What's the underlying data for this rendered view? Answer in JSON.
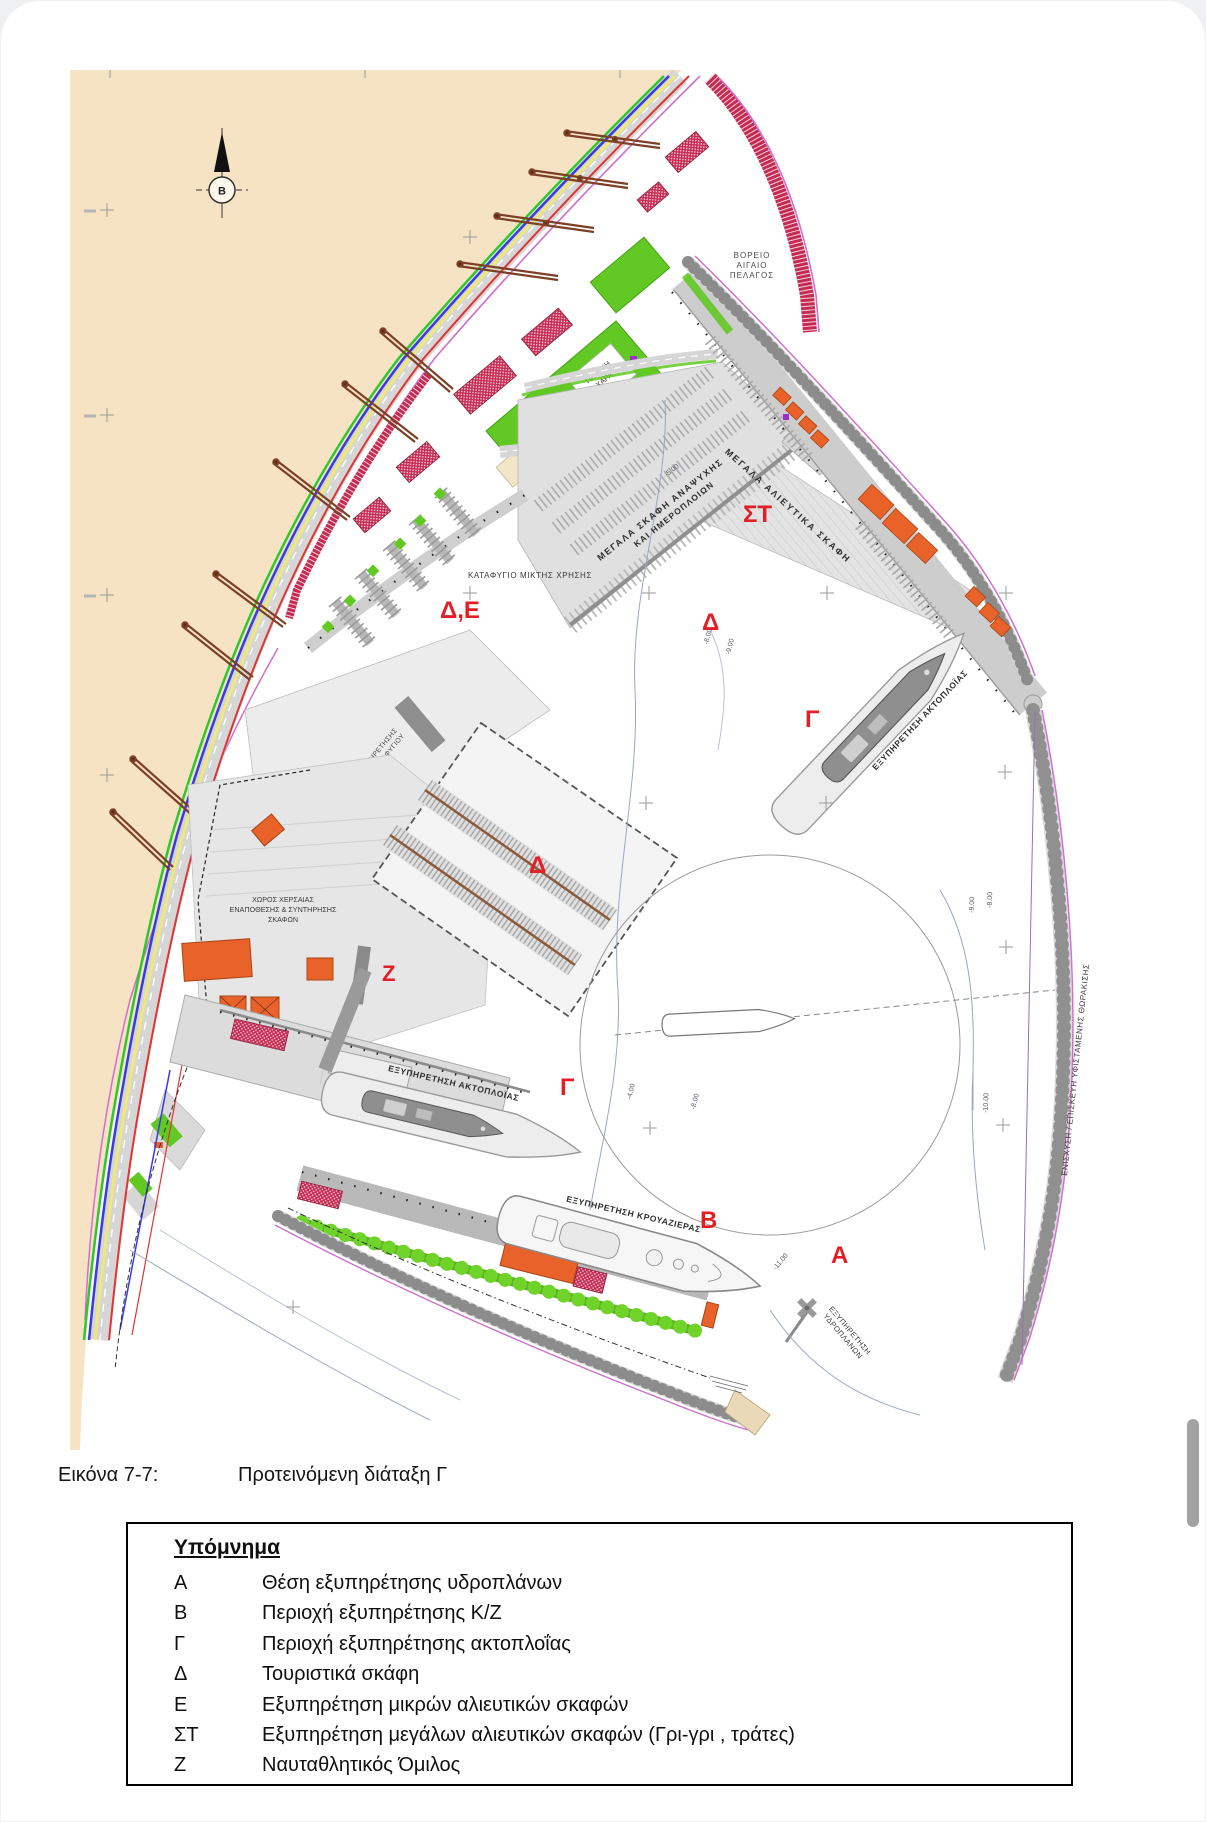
{
  "caption": {
    "figure_label": "Εικόνα 7-7:",
    "figure_title": "Προτεινόμενη διάταξη Γ"
  },
  "legend": {
    "title": "Υπόμνημα",
    "items": [
      {
        "key": "Α",
        "label": "Θέση εξυπηρέτησης υδροπλάνων"
      },
      {
        "key": "Β",
        "label": "Περιοχή εξυπηρέτησης Κ/Ζ"
      },
      {
        "key": "Γ",
        "label": "Περιοχή εξυπηρέτησης ακτοπλοΐας"
      },
      {
        "key": "Δ",
        "label": "Τουριστικά σκάφη"
      },
      {
        "key": "Ε",
        "label": "Εξυπηρέτηση μικρών αλιευτικών σκαφών"
      },
      {
        "key": "ΣΤ",
        "label": "Εξυπηρέτηση μεγάλων αλιευτικών σκαφών (Γρι-γρι , τράτες)"
      },
      {
        "key": "Ζ",
        "label": "Ναυταθλητικός Όμιλος"
      }
    ]
  },
  "map": {
    "north_indicator": "Β",
    "sea_name": {
      "l1": "ΒΟΡΕΙΟ",
      "l2": "ΑΙΓΑΙΟ",
      "l3": "ΠΕΛΑΓΟΣ"
    },
    "zones": {
      "marina": "Δ,Ε",
      "fishing_large": "ΣΤ",
      "leisure": "Δ",
      "boatyard": "Δ",
      "ferry_east": "Γ",
      "ferry_south": "Γ",
      "club": "Ζ",
      "cruise": "Β",
      "seaplane": "Α"
    },
    "areas": {
      "mixed_refuge": "ΚΑΤΑΦΥΓΙΟ ΜΙΚΤΗΣ ΧΡΗΣΗΣ",
      "leisure_pier_1": "ΜΕΓΑΛΑ ΣΚΑΦΗ ΑΝΑΨΥΧΗΣ",
      "leisure_pier_2": "ΚΑΙ ΗΜΕΡΟΠΛΟΙΩΝ",
      "fishing_quay": "ΜΕΓΑΛΑ ΑΛΙΕΥΤΙΚΑ ΣΚΑΦΗ",
      "ferry_quay_east": "ΕΞΥΠΗΡΕΤΗΣΗ ΑΚΤΟΠΛΟΪΑΣ",
      "ferry_quay_south": "ΕΞΥΠΗΡΕΤΗΣΗ ΑΚΤΟΠΛΟΪΑΣ",
      "cruise_quay": "ΕΞΥΠΗΡΕΤΗΣΗ ΚΡΟΥΑΖΙΕΡΑΣ",
      "seaplane_1": "ΕΞΥΠΗΡΕΤΗΣΗ",
      "seaplane_2": "ΥΔΡΟΠΛΑΝΩΝ",
      "yard_1": "ΧΩΡΟΣ ΧΕΡΣΑΙΑΣ",
      "yard_2": "ΕΝΑΠΟΘΕΣΗΣ & ΣΥΝΤΗΡΗΣΗΣ",
      "yard_3": "ΣΚΑΦΩΝ",
      "tourist_1": "ΠΕΡΙΟΧΗ ΕΞΥΠΗΡΕΤΗΣΗΣ",
      "tourist_2": "ΤΟΥΡΙΣΤΙΚΟΥ ΚΑΤΑΦΥΓΙΟΥ",
      "armor": "ΕΝΙΣΧΥΣΗ / ΕΠΙΣΚΕΥΗ ΥΦΙΣΤΑΜΕΝΗΣ ΘΩΡΑΚΙΣΗΣ",
      "playground_1": "ΠΑΙΔΙΚΗ",
      "playground_2": "ΧΑΡΑ"
    },
    "depths": {
      "d1": "-5.00",
      "d2": "-8.00",
      "d3": "-9.00",
      "d4": "-9.00",
      "d5": "-8.00",
      "d6": "-10.00",
      "d7": "-4.00",
      "d8": "-8.00",
      "d9": "-11.00"
    },
    "colors": {
      "land": "#f5e3c4",
      "quay": "#c9c9c9",
      "park": "#62c824",
      "building_orange": "#e8622a",
      "building_crimson": "#c52a52",
      "zone_red": "#e31e24",
      "magenta_line": "#cf6fcf",
      "contour": "#9aa6c8"
    }
  }
}
